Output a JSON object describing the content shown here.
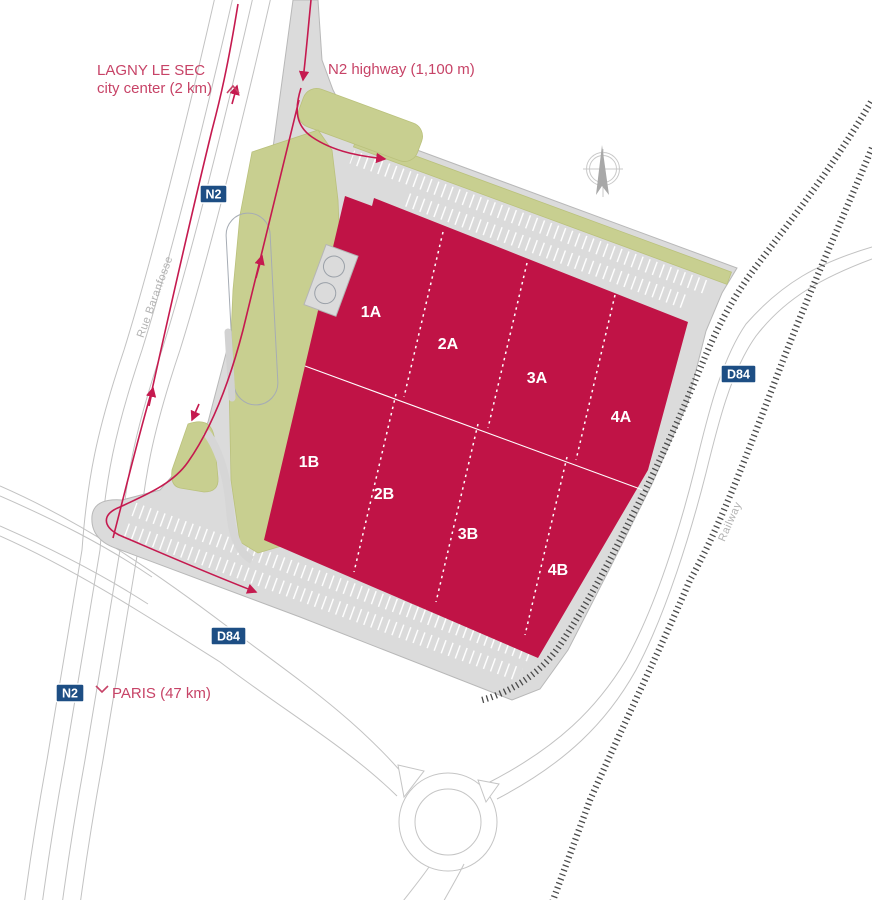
{
  "annotations": {
    "top_destination": {
      "line1": "LAGNY LE SEC",
      "line2": "city center (2 km)"
    },
    "highway_exit": "N2 highway (1,100 m)",
    "bottom_destination": "PARIS (47 km)",
    "street_name": "Rue Baranfosse",
    "railway_label": "Railway"
  },
  "road_badges": {
    "n2_north": "N2",
    "n2_south": "N2",
    "d84_east": "D84",
    "d84_west": "D84"
  },
  "building_units": [
    "1A",
    "2A",
    "3A",
    "4A",
    "1B",
    "2B",
    "3B",
    "4B"
  ],
  "colors": {
    "building": "#c01346",
    "route_arrow": "#c51a4f",
    "annotation_text": "#c74367",
    "badge_blue": "#1d4e84",
    "green_area": "#c8cf90",
    "paving": "#dbdbdb",
    "railway": "#4a4a4a",
    "road_line": "#c2c2c2"
  }
}
